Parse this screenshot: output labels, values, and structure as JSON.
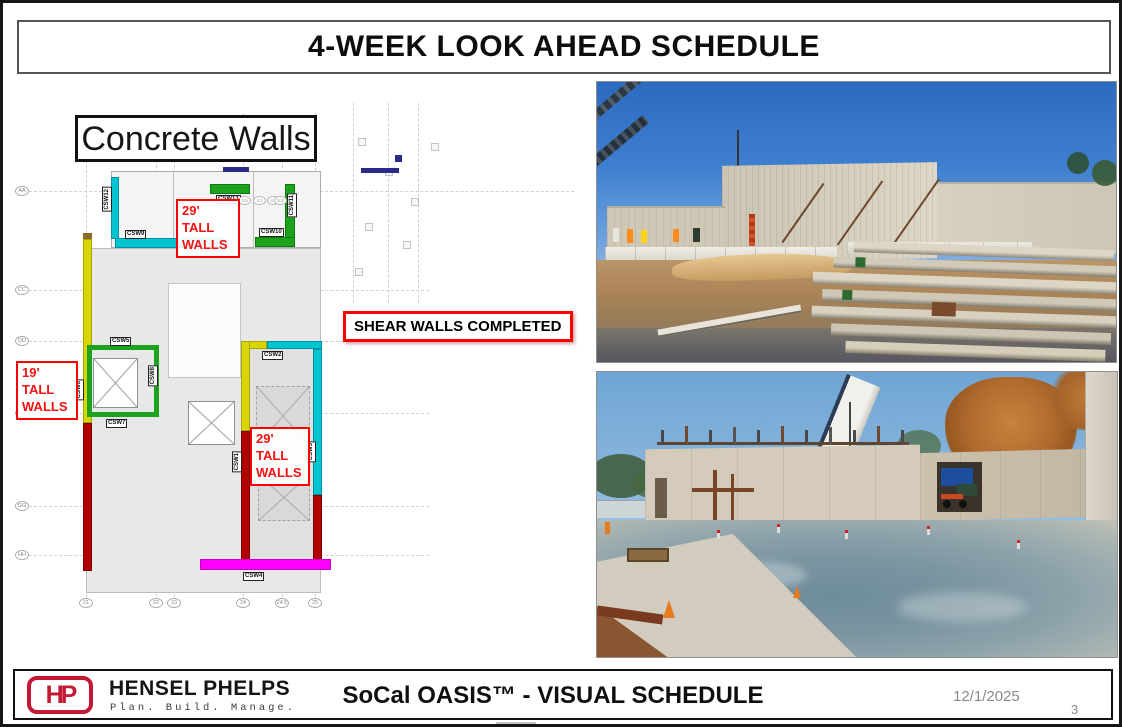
{
  "slide": {
    "title": "4-WEEK LOOK AHEAD SCHEDULE",
    "date": "12/1/2025",
    "page_number": "3"
  },
  "plan": {
    "title": "Concrete Walls",
    "annotations": {
      "tall29_top": "29' TALL WALLS",
      "tall29_bottom": "29' TALL WALLS",
      "tall19": "19' TALL WALLS",
      "shear": "SHEAR WALLS COMPLETED"
    },
    "walls": {
      "csw1": "CSW1",
      "csw2": "CSW2",
      "csw3": "CSW3",
      "csw4": "CSW4",
      "csw5": "CSW5",
      "csw6": "CSW6",
      "csw7": "CSW7",
      "csw8": "CSW8",
      "csw9": "CSW9",
      "csw10": "CSW10",
      "csw11": "CSW11",
      "csw12": "CSW12",
      "csw13": "CSW13"
    },
    "grid_columns": [
      "21",
      "22",
      "23",
      "24",
      "24.5",
      "25"
    ],
    "grid_rows": [
      "AA",
      "CC",
      "DD",
      "EE",
      "GG",
      "HH"
    ],
    "mini_bubbles": [
      "3.5",
      "4.2",
      "4.7",
      "5.2"
    ],
    "colors": {
      "cyan": "#00C5CE",
      "green": "#1CA21C",
      "yellow": "#D8D500",
      "dark_red": "#B00000",
      "magenta": "#FF00FF",
      "highlight_red": "#FF0000"
    }
  },
  "footer": {
    "logo_text": "HP",
    "company": "HENSEL PHELPS",
    "tagline": "Plan. Build. Manage.",
    "center_title": "SoCal OASIS™ - VISUAL SCHEDULE"
  }
}
